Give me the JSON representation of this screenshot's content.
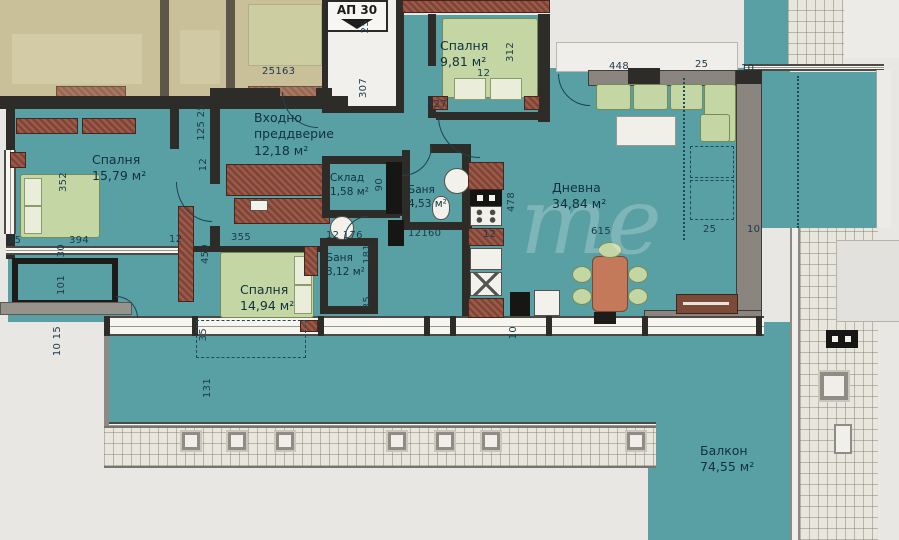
{
  "plan": {
    "unit_label": "АП 30",
    "watermark": "те",
    "rooms": {
      "bedroom_top": {
        "name": "Спалня",
        "area": "9,81 м²"
      },
      "entrance": {
        "name_line1": "Входно",
        "name_line2": "преддверие",
        "area": "12,18 м²"
      },
      "bedroom_left": {
        "name": "Спалня",
        "area": "15,79 м²"
      },
      "storage": {
        "name": "Склад",
        "area": "1,58 м²"
      },
      "bathroom_main": {
        "name": "Баня",
        "area": "4,53 м²"
      },
      "bathroom_small": {
        "name": "Баня",
        "area": "3,12 м²"
      },
      "bedroom_bottom": {
        "name": "Спалня",
        "area": "14,94 м²"
      },
      "living_room": {
        "name": "Дневна",
        "area": "34,84 м²"
      },
      "balcony": {
        "name": "Балкон",
        "area": "74,55 м²"
      }
    },
    "dimensions": [
      {
        "t": "25163"
      },
      {
        "t": "12"
      },
      {
        "t": "25"
      },
      {
        "t": "307"
      },
      {
        "t": "327"
      },
      {
        "t": "312"
      },
      {
        "t": "448"
      },
      {
        "t": "25"
      },
      {
        "t": "10"
      },
      {
        "t": "125 25"
      },
      {
        "t": "12"
      },
      {
        "t": "352"
      },
      {
        "t": "394"
      },
      {
        "t": "25"
      },
      {
        "t": "30"
      },
      {
        "t": "101"
      },
      {
        "t": "10 15"
      },
      {
        "t": "12"
      },
      {
        "t": "355"
      },
      {
        "t": "459"
      },
      {
        "t": "35"
      },
      {
        "t": "131"
      },
      {
        "t": "12 176"
      },
      {
        "t": "181"
      },
      {
        "t": "35"
      },
      {
        "t": "90"
      },
      {
        "t": "12160"
      },
      {
        "t": "12"
      },
      {
        "t": "478"
      },
      {
        "t": "10"
      },
      {
        "t": "615"
      },
      {
        "t": "25"
      },
      {
        "t": "10"
      }
    ],
    "colors": {
      "floor_teal": "#59a0a5",
      "wall_dark": "#2e2c29",
      "wall_grey": "#8b8580",
      "furniture_green": "#c4d6a3",
      "wardrobe_red": "#8a4a3c",
      "neighbor_beige": "#c9c09a",
      "paving": "#e9e7dd"
    }
  }
}
